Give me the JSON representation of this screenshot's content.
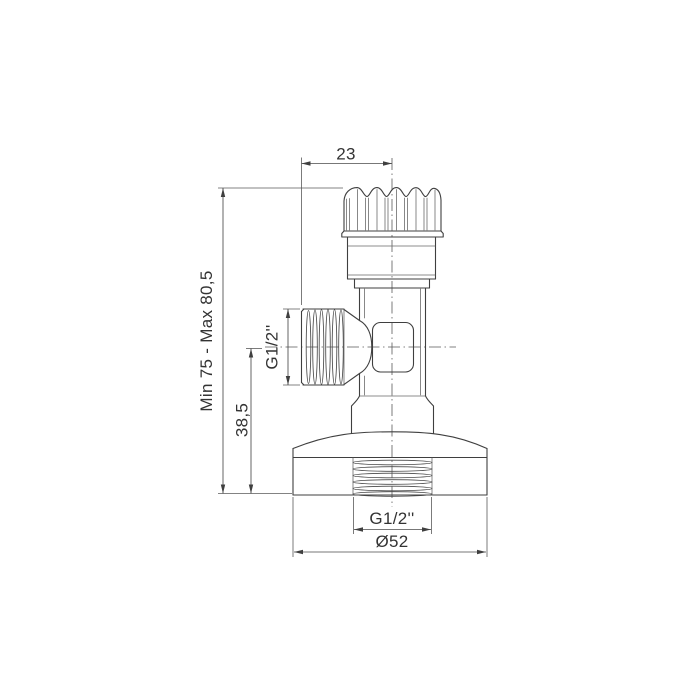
{
  "drawing": {
    "type": "technical-dimension-drawing",
    "subject": "angle-valve-side-view",
    "colors": {
      "background": "#ffffff",
      "line": "#3f3f3f",
      "thin_line": "#5a5a5a",
      "text": "#333333"
    },
    "dimensions": {
      "top_offset": "23",
      "height_range": "Min 75 - Max 80,5",
      "outlet_axis_height": "38,5",
      "side_outlet_thread": "G1/2''",
      "bottom_thread": "G1/2''",
      "base_diameter": "Ø52"
    }
  }
}
